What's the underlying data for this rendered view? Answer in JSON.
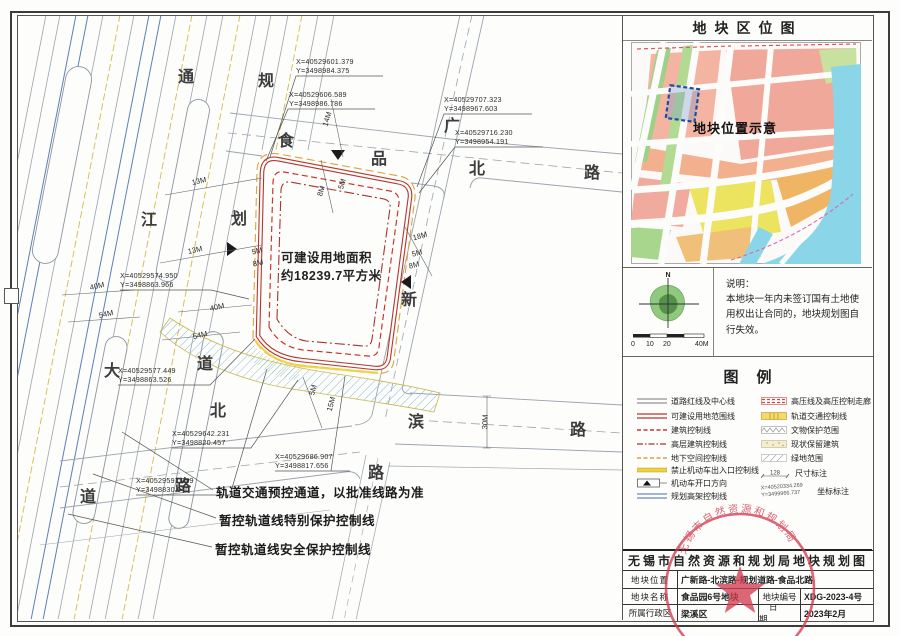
{
  "map": {
    "area_label": "可建设用地面积\n约18239.7平方米",
    "roads": [
      {
        "name": "通江大道",
        "chars": [
          "通",
          "江",
          "大",
          "道"
        ]
      },
      {
        "name": "规划道路",
        "chars": [
          "规",
          "划",
          "道",
          "路"
        ]
      },
      {
        "name": "食品北路",
        "chars": [
          "食",
          "品",
          "北",
          "路"
        ]
      },
      {
        "name": "广新路",
        "chars": [
          "广",
          "新",
          "路"
        ]
      },
      {
        "name": "北滨路",
        "chars": [
          "北",
          "滨",
          "路"
        ]
      }
    ],
    "coordinates": [
      "X=40529601.379\nY=3498984.375",
      "X=40529606.589\nY=3498986.786",
      "X=40529707.323\nY=3498967.603",
      "X=40529716.230\nY=3498954.191",
      "X=40529574.950\nY=3498863.966",
      "X=40529577.449\nY=3498863.526",
      "X=40529597.039\nY=3498830.040",
      "X=40529642.231\nY=3498820.457",
      "X=40529686.907\nY=3498817.656"
    ],
    "dimensions": [
      "14M",
      "8M",
      "5M",
      "13M",
      "13M",
      "5M",
      "8M",
      "40M",
      "40M",
      "54M",
      "54M",
      "18M",
      "5M",
      "8M",
      "5M",
      "15M",
      "30M"
    ],
    "notes": [
      "轨道交通预控通道，以批准线路为准",
      "暂控轨道线特别保护控制线",
      "暂控轨道线安全保护控制线"
    ]
  },
  "panel": {
    "title": "地块区位图",
    "location_map": {
      "label": "地块位置示意"
    },
    "compass": {
      "north": "N",
      "scale_labels": [
        "0",
        "10",
        "20",
        "40M"
      ]
    },
    "notes": {
      "heading": "说明：",
      "body": "本地块一年内未签订国有土地使用权出让合同的，地块规划图自行失效。"
    },
    "legend": {
      "title": "图例",
      "left": [
        "道路红线及中心线",
        "可建设用地范围线",
        "建筑控制线",
        "高层建筑控制线",
        "地下空间控制线",
        "禁止机动车出入口控制线",
        "机动车开口方向",
        "规划高架控制线"
      ],
      "right": [
        "高压线及高压控制走廊",
        "轨道交通控制线",
        "文物保护范围",
        "现状保留建筑",
        "绿地范围",
        "尺寸标注",
        "坐标标注"
      ],
      "dim_example": "128",
      "coord_example": "X=40520334.269\nY=3499966.737"
    },
    "title_block": {
      "title": "无锡市自然资源和规划局地块规划图",
      "location_label": "地块位置",
      "location_value": "广新路-北滨路-规划道路-食品北路",
      "name_label": "地块名称",
      "name_value": "食品园6号地块",
      "number_label": "地块编号",
      "number_value": "XDG-2023-4号",
      "district_label": "所属行政区",
      "district_value": "梁溪区",
      "date_label": "日期",
      "date_value": "2023年2月"
    }
  },
  "stamp": {
    "text": "无锡市自然资源和规划局"
  },
  "colors": {
    "plot_red": "#b5362b",
    "building_control_red": "#cc3629",
    "underground_orange": "#dfa23f",
    "no_access_yellow": "#ecd23f",
    "elevated_blue": "#6a8cc2",
    "rail_hatch_blue": "#7fb3cc",
    "seal_red": "#d23c50"
  }
}
